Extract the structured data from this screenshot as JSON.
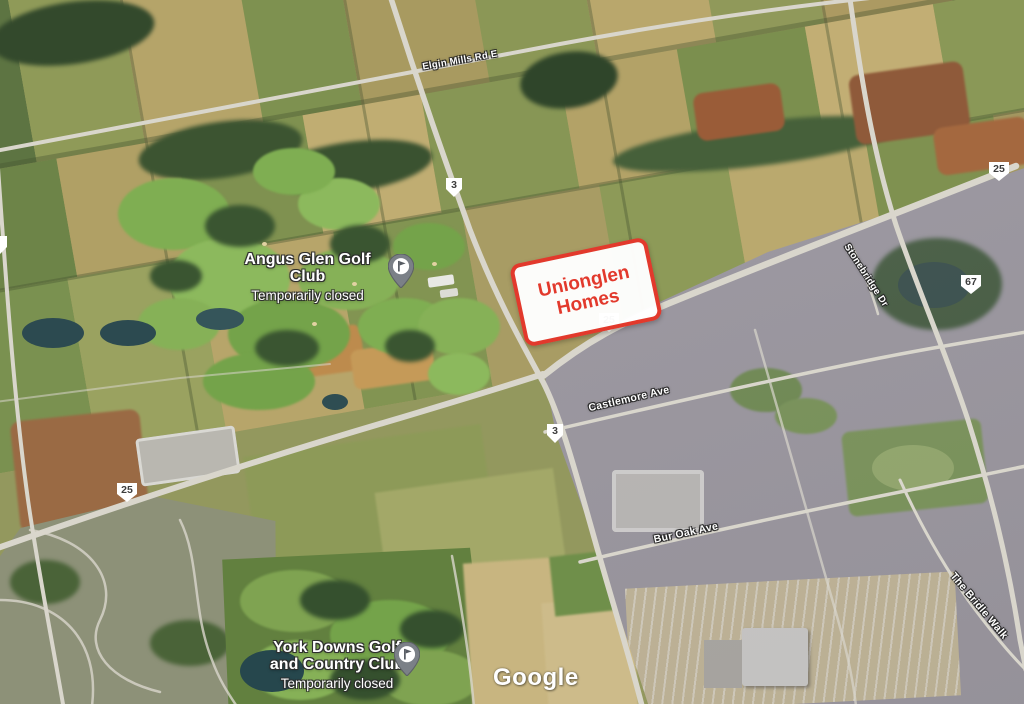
{
  "map": {
    "attribution": "Google",
    "annotation": {
      "line1": "Unionglen",
      "line2": "Homes",
      "color": "#e2392c"
    },
    "pois": [
      {
        "name": "Angus Glen Golf Club",
        "status": "Temporarily closed",
        "icon": "golf-pin"
      },
      {
        "name_line1": "York Downs Golf",
        "name_line2": "and Country Club",
        "status": "Temporarily closed",
        "icon": "golf-pin"
      }
    ],
    "route_shields": [
      {
        "number": "3"
      },
      {
        "number": "25"
      },
      {
        "number": "67"
      },
      {
        "number": "25"
      },
      {
        "number": "3"
      },
      {
        "number": "25"
      },
      {
        "number": ""
      }
    ],
    "street_labels": [
      {
        "text": "Elgin Mills Rd E"
      },
      {
        "text": "Stonebridge Dr"
      },
      {
        "text": "Castlemore Ave"
      },
      {
        "text": "Bur Oak Ave"
      },
      {
        "text": "The Bridle Walk"
      }
    ],
    "colors": {
      "annotation_red": "#e2392c",
      "road": "#d9d6cc",
      "label_text": "#ffffff"
    }
  }
}
